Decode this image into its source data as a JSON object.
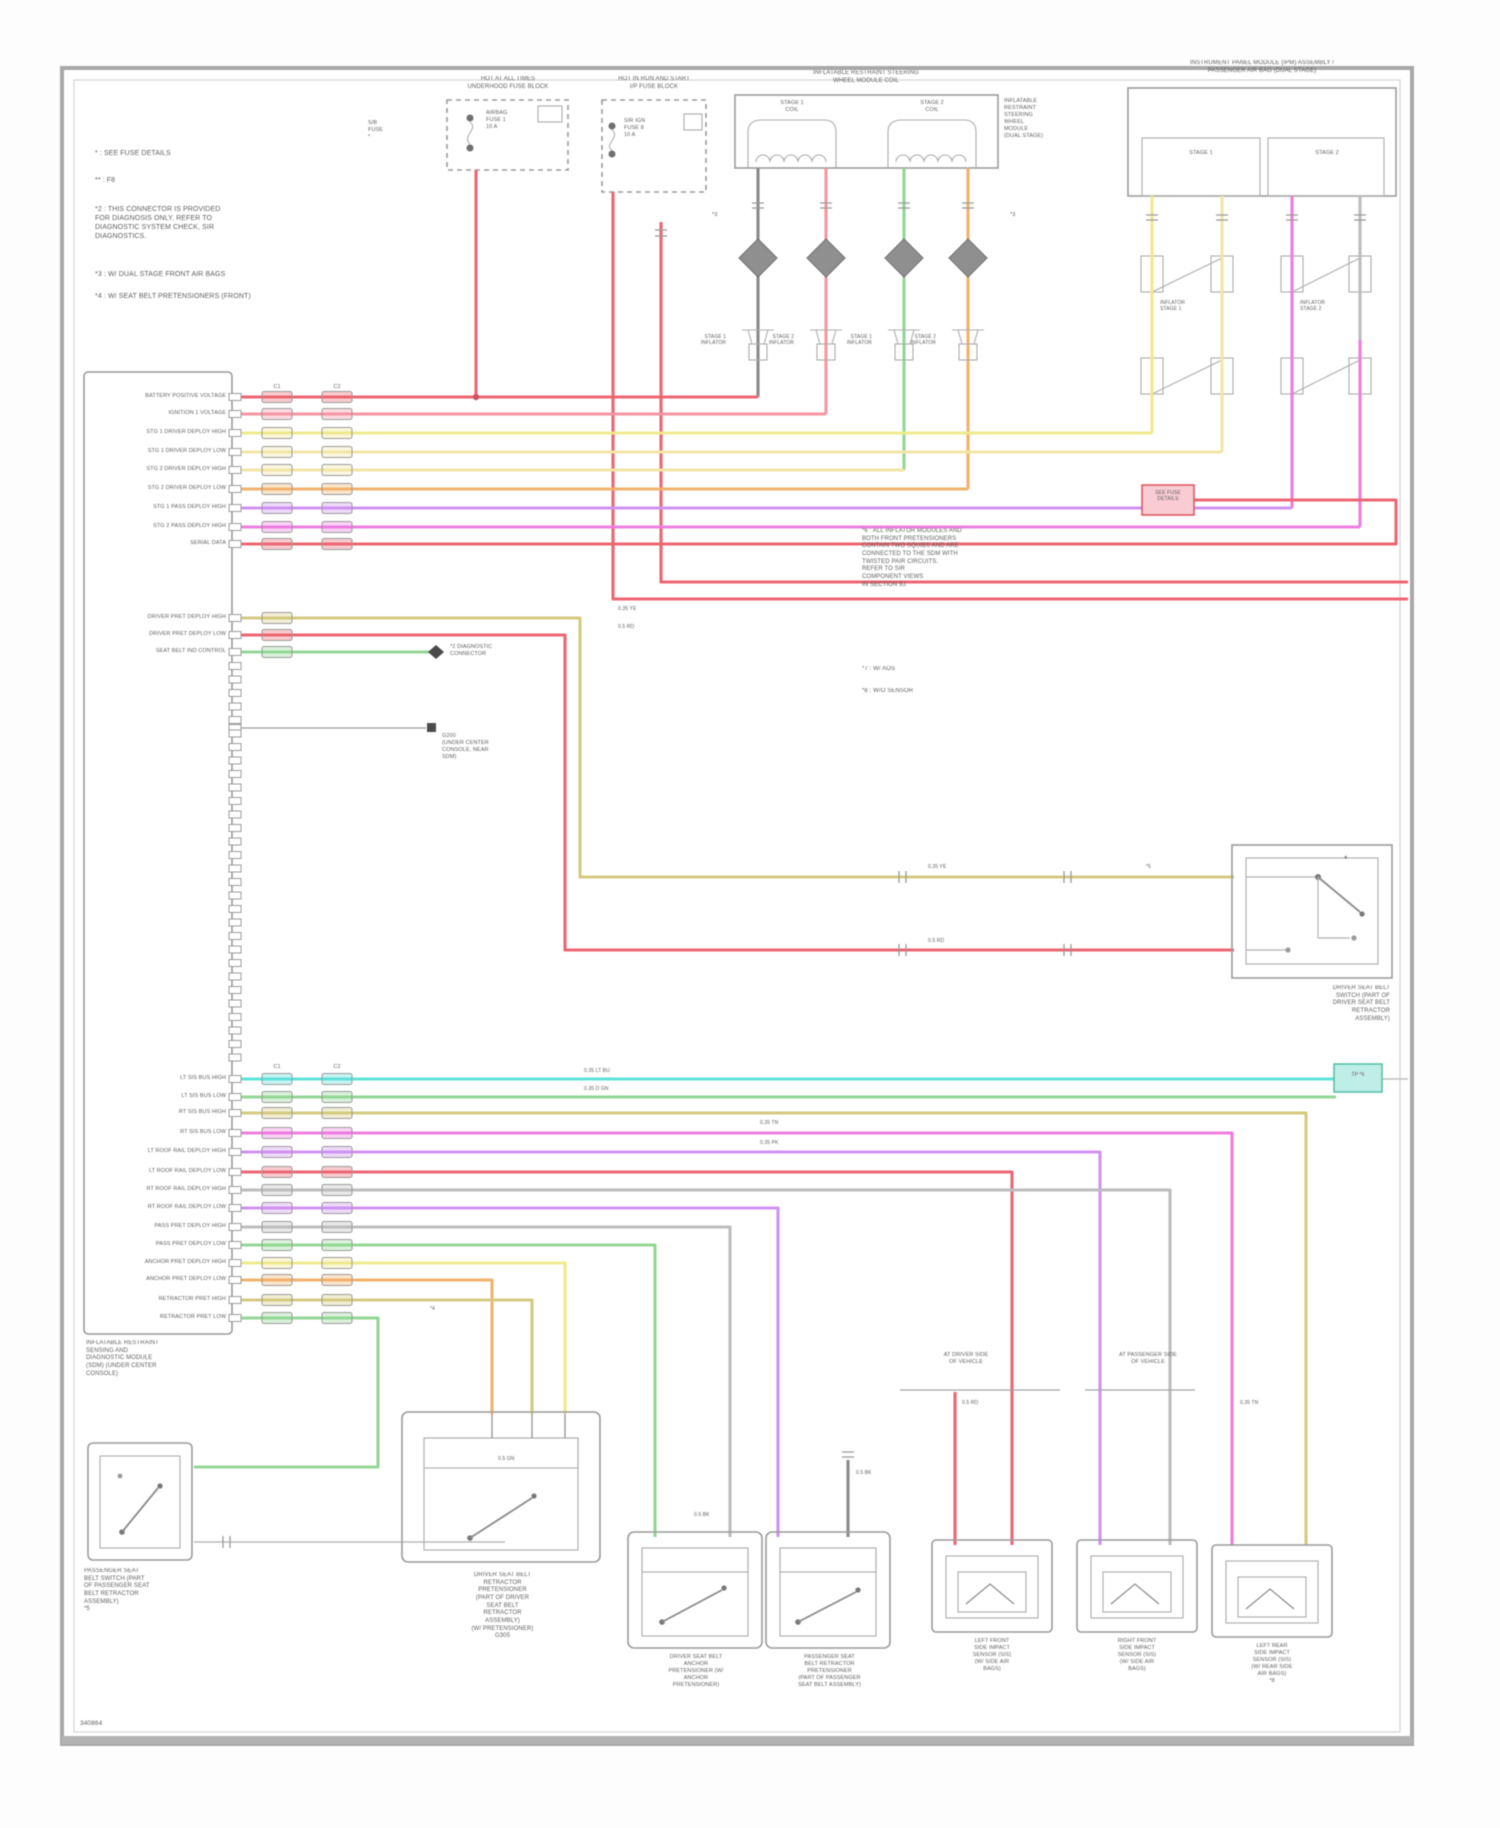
{
  "palette": {
    "red": "#ec6672",
    "pink": "#f595a5",
    "yellow": "#efe98c",
    "pale_yellow": "#f2e5a6",
    "orange": "#f2b26b",
    "violet": "#cf92f0",
    "magenta": "#ef7ce0",
    "cyan": "#5ee0da",
    "green": "#93d795",
    "tan": "#d5ca80",
    "gray": "#bdbdbd",
    "box_gray": "#9b9b9b"
  },
  "footer": {
    "doc_id": "340864"
  },
  "notes": {
    "n1": "* : SEE FUSE DETAILS",
    "n2": "** : F8",
    "n3": "*2 : THIS CONNECTOR IS PROVIDED\nFOR DIAGNOSIS ONLY. REFER TO\nDIAGNOSTIC SYSTEM CHECK, SIR\nDIAGNOSTICS.",
    "n4": "*3 : W/ DUAL STAGE FRONT AIR BAGS",
    "n5": "*4 : W/ SEAT BELT PRETENSIONERS (FRONT)"
  },
  "fuse1": {
    "header": "HOT AT ALL TIMES\nUNDERHOOD FUSE BLOCK",
    "fuse": "AIRBAG\nFUSE 1\n10 A",
    "side": "S/B\nFUSE\n*"
  },
  "fuse2": {
    "header": "HOT IN RUN AND START\nI/P FUSE BLOCK",
    "fuse": "SIR IGN\nFUSE 8\n10 A"
  },
  "coil": {
    "header": "INFLATABLE RESTRAINT STEERING\nWHEEL MODULE COIL",
    "stage1": "STAGE 1\nCOIL",
    "stage2": "STAGE 2\nCOIL",
    "side": "INFLATABLE\nRESTRAINT\nSTEERING\nWHEEL\nMODULE\n(DUAL STAGE)"
  },
  "pab": {
    "header": "INSTRUMENT PANEL MODULE (IPM) ASSEMBLY /\nPASSENGER AIR BAG (DUAL STAGE)",
    "stage1": "STAGE 1",
    "stage2": "STAGE 2",
    "inf1": "INFLATOR\nSTAGE 1",
    "inf2": "INFLATOR\nSTAGE 2"
  },
  "squibs": {
    "s1": "STAGE 1\nINFLATOR",
    "s2": "STAGE 2\nINFLATOR",
    "s3": "STAGE 1\nINFLATOR",
    "s4": "STAGE 2\nINFLATOR",
    "m1": "*3",
    "m2": "*3"
  },
  "sdm": {
    "caption": "INFLATABLE RESTRAINT\nSENSING AND\nDIAGNOSTIC MODULE\n(SDM) (UNDER CENTER\nCONSOLE)",
    "conn1": "C1",
    "conn2": "C2",
    "conn3": "C1",
    "conn4": "C2",
    "pins_top": [
      "BATTERY POSITIVE VOLTAGE",
      "IGNITION 1 VOLTAGE",
      "STG 1 DRIVER DEPLOY HIGH",
      "STG 1 DRIVER DEPLOY LOW",
      "STG 2 DRIVER DEPLOY HIGH",
      "STG 2 DRIVER DEPLOY LOW",
      "STG 1 PASS DEPLOY HIGH",
      "STG 2 PASS DEPLOY HIGH",
      "SERIAL DATA"
    ],
    "pins_mid": [
      "DRIVER PRET DEPLOY HIGH",
      "DRIVER PRET DEPLOY LOW",
      "SEAT BELT IND CONTROL"
    ],
    "ground_label": "G200\n(UNDER CENTER\nCONSOLE, NEAR\nSDM)",
    "marker_label": "*2 DIAGNOSTIC\nCONNECTOR",
    "pins_bot": [
      "LT SIS BUS HIGH",
      "LT SIS BUS LOW",
      "RT SIS BUS HIGH",
      "RT SIS BUS LOW",
      "LT ROOF RAIL DEPLOY HIGH",
      "LT ROOF RAIL DEPLOY LOW",
      "RT ROOF RAIL DEPLOY HIGH",
      "RT ROOF RAIL DEPLOY LOW",
      "PASS PRET DEPLOY HIGH",
      "PASS PRET DEPLOY LOW",
      "ANCHOR PRET DEPLOY HIGH",
      "ANCHOR PRET DEPLOY LOW",
      "RETRACTOR PRET HIGH",
      "RETRACTOR PRET LOW"
    ]
  },
  "right_notes": {
    "p": "*6 : ALL INFLATOR MODULES AND\nBOTH FRONT PRETENSIONERS\nCONTAIN TWO SQUIBS AND ARE\nCONNECTED TO THE SDM WITH\nTWISTED PAIR CIRCUITS.\nREFER TO SIR\nCOMPONENT VIEWS\nIN SECTION 9J.",
    "s1": "*7 : W/ AOS",
    "s2": "*8 : W/O SENSOR"
  },
  "belt_switch": {
    "caption": "DRIVER SEAT BELT\nSWITCH (PART OF\nDRIVER SEAT BELT\nRETRACTOR\nASSEMBLY)",
    "asterisk": "*"
  },
  "see_fuse_box": "SEE FUSE\nDETAILS",
  "twisted_pair_box": "TP *6",
  "left_switch": {
    "caption": "PASSENGER SEAT\nBELT SWITCH (PART\nOF PASSENGER SEAT\nBELT RETRACTOR\nASSEMBLY)\n*5"
  },
  "retractor": {
    "caption": "DRIVER SEAT BELT\nRETRACTOR\nPRETENSIONER\n(PART OF DRIVER\nSEAT BELT\nRETRACTOR\nASSEMBLY)\n(W/ PRETENSIONER)\nG305"
  },
  "comp_a": {
    "caption": "DRIVER SEAT BELT\nANCHOR\nPRETENSIONER (W/\nANCHOR\nPRETENSIONER)"
  },
  "comp_b": {
    "caption": "PASSENGER SEAT\nBELT RETRACTOR\nPRETENSIONER\n(PART OF PASSENGER\nSEAT BELT ASSEMBLY)"
  },
  "headers_right": {
    "h1": "AT DRIVER SIDE\nOF VEHICLE",
    "h2": "AT PASSENGER SIDE\nOF VEHICLE"
  },
  "comp_c1": {
    "caption": "LEFT FRONT\nSIDE IMPACT\nSENSOR (SIS)\n(W/ SIDE AIR\nBAGS)"
  },
  "comp_c2": {
    "caption": "RIGHT FRONT\nSIDE IMPACT\nSENSOR (SIS)\n(W/ SIDE AIR\nBAGS)"
  },
  "comp_c3": {
    "caption": "LEFT REAR\nSIDE IMPACT\nSENSOR (SIS)\n(W/ REAR SIDE\nAIR BAGS)\n*8"
  },
  "wire_tags": {
    "t1": "0.35 YE",
    "t2": "0.5 RD",
    "t3": "0.35 YE",
    "t4": "0.5 RD",
    "t5": "*5",
    "t6": "0.35 LT BU",
    "t7": "0.35 D GN",
    "t8": "0.35 TN",
    "t9": "0.35 PK",
    "t10": "*4",
    "t11": "0.5 GN",
    "t12": "0.5 BK",
    "t13": "0.5 BK",
    "t14": "0.5 RD",
    "t15": "0.35 TN",
    "t16": "*3",
    "t17": "*3"
  }
}
